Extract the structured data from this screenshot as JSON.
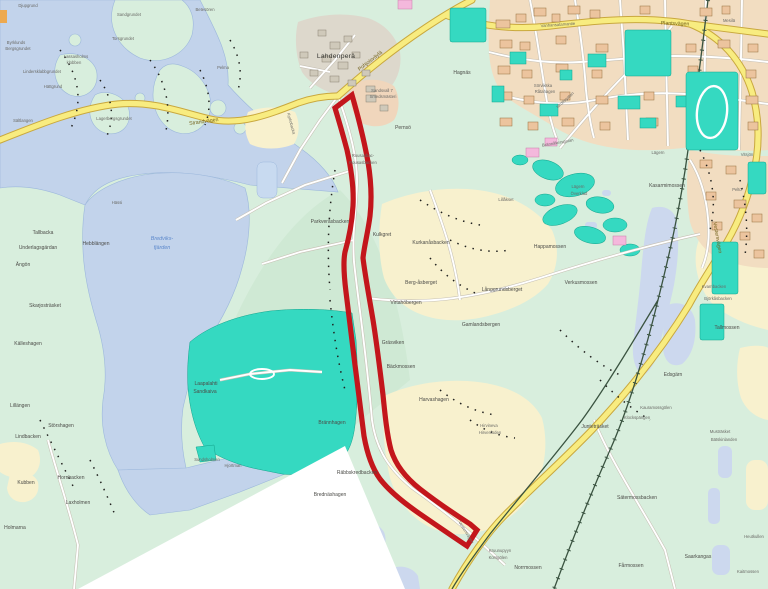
{
  "map": {
    "type": "municipal plan map with highlighted corridor",
    "colors": {
      "land": "#d8eedd",
      "water": "#c2d3eb",
      "wetland": "#ccd8ee",
      "sand_pit": "#35d9c1",
      "field": "#f8f1ce",
      "urban": "#f2ddc1",
      "road_major": "#f8ec80",
      "railway": "#3a5340",
      "corridor": "#c3161c"
    },
    "road_labels": {
      "strandvagen": "Strandvägen",
      "pohjoisvayla": "Pohjoisväylä",
      "plantsvagen": "Plantsvägen",
      "vanhansatamantie": "Vanhansatamantie",
      "vestersvagen": "Vestersvägen",
      "vestersvagen2": "Vestersvägen",
      "idrottsgatan": "Idrottsgatan",
      "brannakersgatan": "Brännåkersgatan",
      "kyrkobacka": "Kyrkobacka"
    },
    "water_labels": {
      "bredviks1": "Bredviks-",
      "bredviks2": "fjärden"
    },
    "place_labels": {
      "lahdenpera": "Lahdenperä",
      "pernso": "Pernsö",
      "hagnas": "Hagnäs",
      "sandsvall1": "Sandsvall 7",
      "sandsvall2": "Smedsmästeri",
      "rousas1": "Rousasbac-",
      "rousas2": "Rousasbacken",
      "parkverasbacken": "Parkveråsbacken",
      "kulkgret": "Kulkgret",
      "kurkanasbacken": "Kurkanåsbacken",
      "bergasberget": "Berg-åsberget",
      "langgrundsberget": "Långgrundsberget",
      "virtahobergen": "Virtahöbergen",
      "gamlandsbergen": "Gamlandsbergen",
      "grasviken": "Gräsviken",
      "backmossen": "Bäckmossen",
      "harvashagen": "Harvashagen",
      "brannhagen": "Brännhagen",
      "hirvineva1": "Hirvineva",
      "hirvineva2": "Hirvenloden",
      "rabbskredbacken": "Räbbskredbacken",
      "brednashagen": "Brednäshagen",
      "kruunupyyn1": "Kruunupyyn",
      "kruunupyyn2": "Korsgölen",
      "norrmossen": "Norrmossen",
      "laapalahti1": "Laapalahti",
      "laapalahti2": "Sandkaiva",
      "djupgrund": "Djupgrund",
      "betesoren": "Betesören",
      "sandgrundet": "Sandgrundet",
      "torsgrundet": "Torsgrundet",
      "byrklunds1": "Byrklunds",
      "byrklunds2": "Bergsgrundet",
      "lassasholms1": "Lassasholms",
      "lassasholms2": "klobben",
      "pelma": "Pelma",
      "lindersklabbgrundet": "Lindersklabbgrundet",
      "hattgrund": "Hättgrund",
      "lagerbergsgrundet": "Lagerbergsgrundet",
      "saltlangen": "Sältlangen",
      "hassi": "Hässi",
      "tallbacka": "Tallbacka",
      "underlagsgardan": "Underlagsgärdan",
      "hebblangen": "Hebblängen",
      "angon": "Ängön",
      "skarjostrasket": "Skarjosträsket",
      "kalleshagen": "Källeshagen",
      "lillangen": "Lillängen",
      "storshagen": "Störshagen",
      "lindbacken": "Lindbacken",
      "kubben": "Kubben",
      "hornbacken": "Hornbacken",
      "laxholmen": "Laxholmen",
      "holmarna": "Holmarna",
      "sundsholmen": "Sundsholmen",
      "hjortman": "Hjortman",
      "mesila": "Mesilä",
      "sorvikska1": "Sörvikska",
      "sorvikska2": "Råtahagen",
      "vitsjon": "Vitsjön",
      "lagern": "Lägern",
      "lagern2": "Lägern",
      "overklad": "Överklad",
      "lillakset": "Lillåkset",
      "kasarmimossen": "Kasarmimossen",
      "pelto": "Pelto",
      "happamossen": "Happamossen",
      "verkusmossen": "Verkusmossen",
      "kvarnbacken": "Kvarnbacken",
      "bjorkasbacken": "Björkåsbacken",
      "tallmossen": "Tallmossen",
      "edsgarn": "Edsgärn",
      "kauramossgolen": "Kauramossgölen",
      "klockspangen": "Klockspängen",
      "juntetrasket": "Junteträsket",
      "mustrasket": "Musträsket",
      "batskinlanden": "Bätskinlanden",
      "satermossbacken": "Sätermossbacken",
      "heutkullen": "Heutkullen",
      "farmossen": "Fårmossen",
      "saarkangas": "Saarkangas",
      "kaitmossen": "Kaitmossen"
    }
  }
}
